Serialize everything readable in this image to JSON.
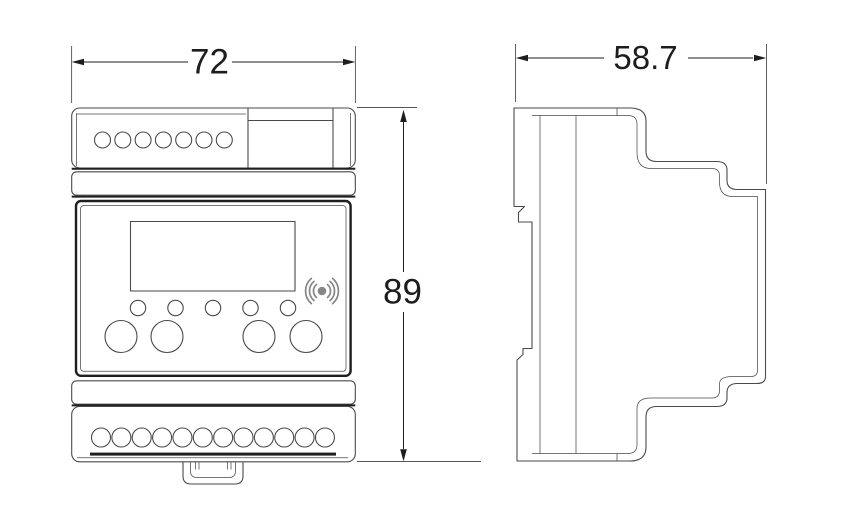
{
  "diagram": {
    "dimensions": {
      "front_width": "72",
      "front_height": "89",
      "side_depth": "58.7"
    },
    "views": {
      "front": {
        "top_terminal_count": 7,
        "bottom_terminal_count": 12,
        "indicator_count": 5,
        "button_count": 4
      },
      "side": {}
    },
    "icons": {
      "wireless": "wireless-signal-icon"
    },
    "colors": {
      "background": "#ffffff",
      "line": "#4a4a4a",
      "bold_line": "#1f1f1f",
      "dimension": "#1d1d1d",
      "icon_gray": "#868686"
    }
  }
}
